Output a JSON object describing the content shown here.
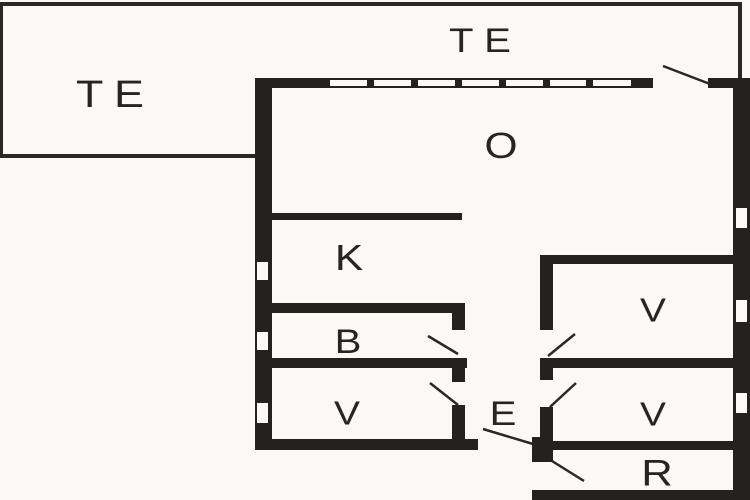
{
  "figure": {
    "kind": "floor-plan",
    "colors": {
      "background": "#faf9f6",
      "walls": "#242120",
      "labels": "#272421"
    }
  },
  "rooms": {
    "terrace_left": {
      "label": "TE"
    },
    "terrace_top": {
      "label": "TE"
    },
    "living_room": {
      "label": "O"
    },
    "kitchen": {
      "label": "K"
    },
    "bathroom": {
      "label": "B"
    },
    "bedroom_left": {
      "label": "V"
    },
    "entrance": {
      "label": "E"
    },
    "bedroom_top_right": {
      "label": "V"
    },
    "bedroom_mid_right": {
      "label": "V"
    },
    "storage": {
      "label": "R"
    }
  }
}
